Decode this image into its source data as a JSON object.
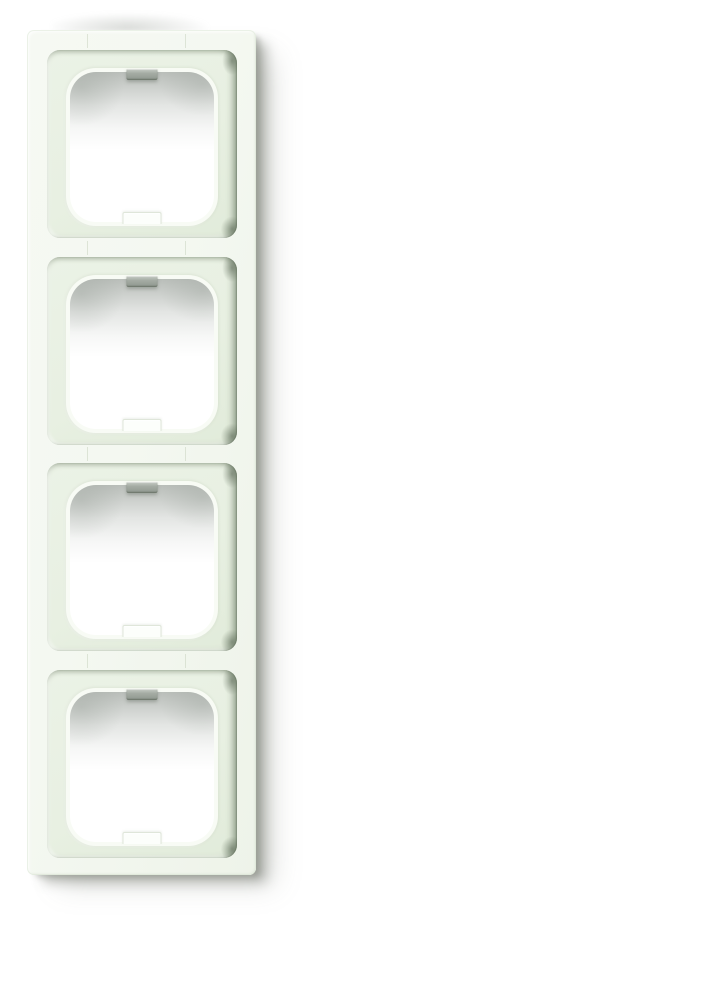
{
  "scene": {
    "type": "product-photograph",
    "subject": "Four-gang vertical switch cover frame, glossy white plastic, photographed on a plain white background with a soft drop shadow to the right and below",
    "background_color": "#ffffff"
  },
  "frame": {
    "module_count": 4,
    "modules": [
      {
        "position": 1,
        "has_top_notch": true,
        "has_bottom_notch": true
      },
      {
        "position": 2,
        "has_top_notch": true,
        "has_bottom_notch": true
      },
      {
        "position": 3,
        "has_top_notch": true,
        "has_bottom_notch": true
      },
      {
        "position": 4,
        "has_top_notch": true,
        "has_bottom_notch": true
      }
    ],
    "colors": {
      "surface": "#f4f8f1",
      "surface_deep": "#eef3e9",
      "recess": "#e8f0e2",
      "recess_deep": "#e1ebda",
      "opening_fill": "#ffffff",
      "top_tab": "#98a097",
      "top_tab_light": "#c7ccc5",
      "bottom_tab": "#fcfefb",
      "bottom_tab_edge": "#dfe6da"
    }
  }
}
